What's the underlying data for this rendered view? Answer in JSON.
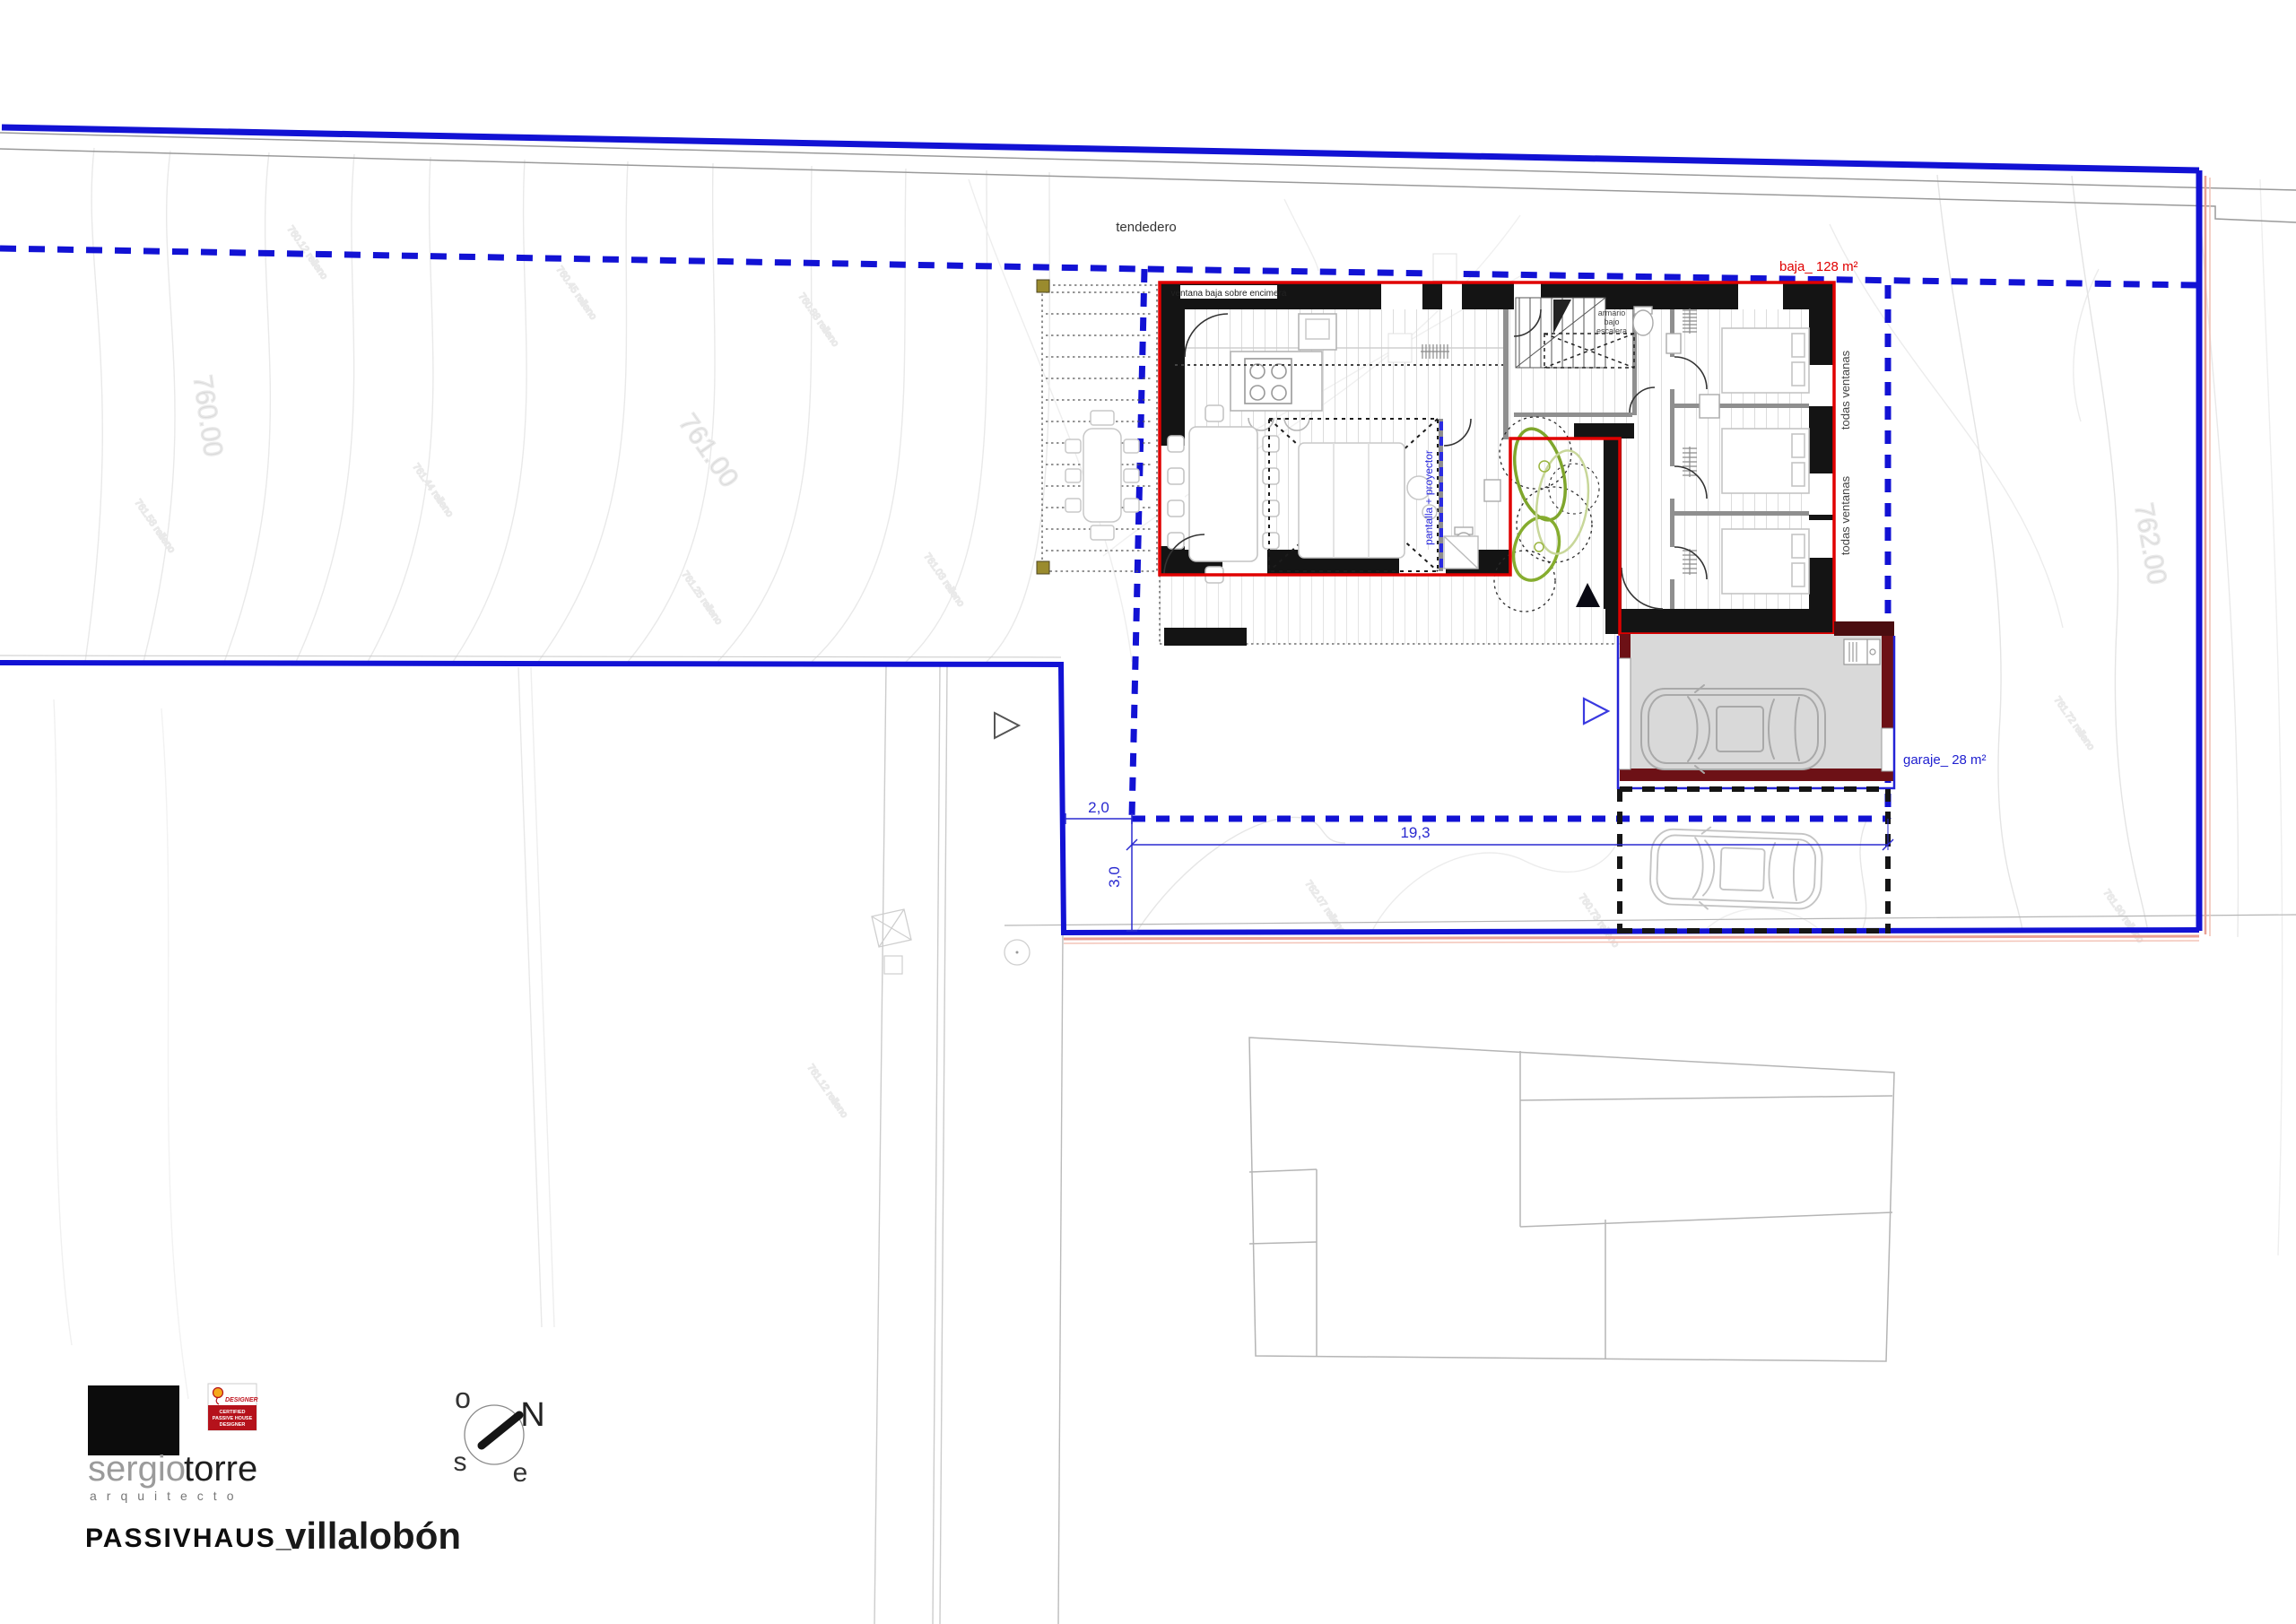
{
  "labels": {
    "tendedero": "tendedero",
    "ventana_baja": "ventana baja sobre encimera",
    "armario_l1": "armario",
    "armario_l2": "bajo",
    "armario_l3": "escalera",
    "pantalla": "pantalla + proyector",
    "todas_ventanas": "todas ventanas",
    "baja_area": "baja_ 128 m²",
    "garaje_area": "garaje_ 28 m²"
  },
  "dimensions": {
    "setback_front": "2,0",
    "plot_width": "19,3",
    "setback_side": "3,0"
  },
  "contour_labels": {
    "c760": "760.00",
    "c761": "761.00",
    "c762": "762.00"
  },
  "survey_points": [
    "760.12 relleno",
    "760.45 relleno",
    "760.88 relleno",
    "761.03 relleno",
    "761.25 relleno",
    "761.44 relleno",
    "761.58 relleno",
    "761.72 relleno",
    "761.90 relleno",
    "762.07 relleno",
    "760.73 relleno",
    "761.12 relleno"
  ],
  "compass": {
    "n": "N",
    "o": "o",
    "s": "s",
    "e": "e"
  },
  "title_block": {
    "brand_first": "sergio",
    "brand_second": "torre",
    "brand_sub": "arquitecto",
    "project_type": "PASSIVHAUS_",
    "project_name": "villalobón",
    "badge": {
      "designer": "DESIGNER",
      "cert_line1": "CERTIFIED",
      "cert_line2": "PASSIVE HOUSE",
      "cert_line3": "DESIGNER"
    }
  },
  "colors": {
    "boundary_blue": "#1212d4",
    "dim_blue": "#2a2ad0",
    "outline_red": "#e00000",
    "garage_wall": "#6d1116",
    "salmon": "#e8a095",
    "tree_green": "#7fa62c",
    "badge_red": "#b5121b"
  }
}
